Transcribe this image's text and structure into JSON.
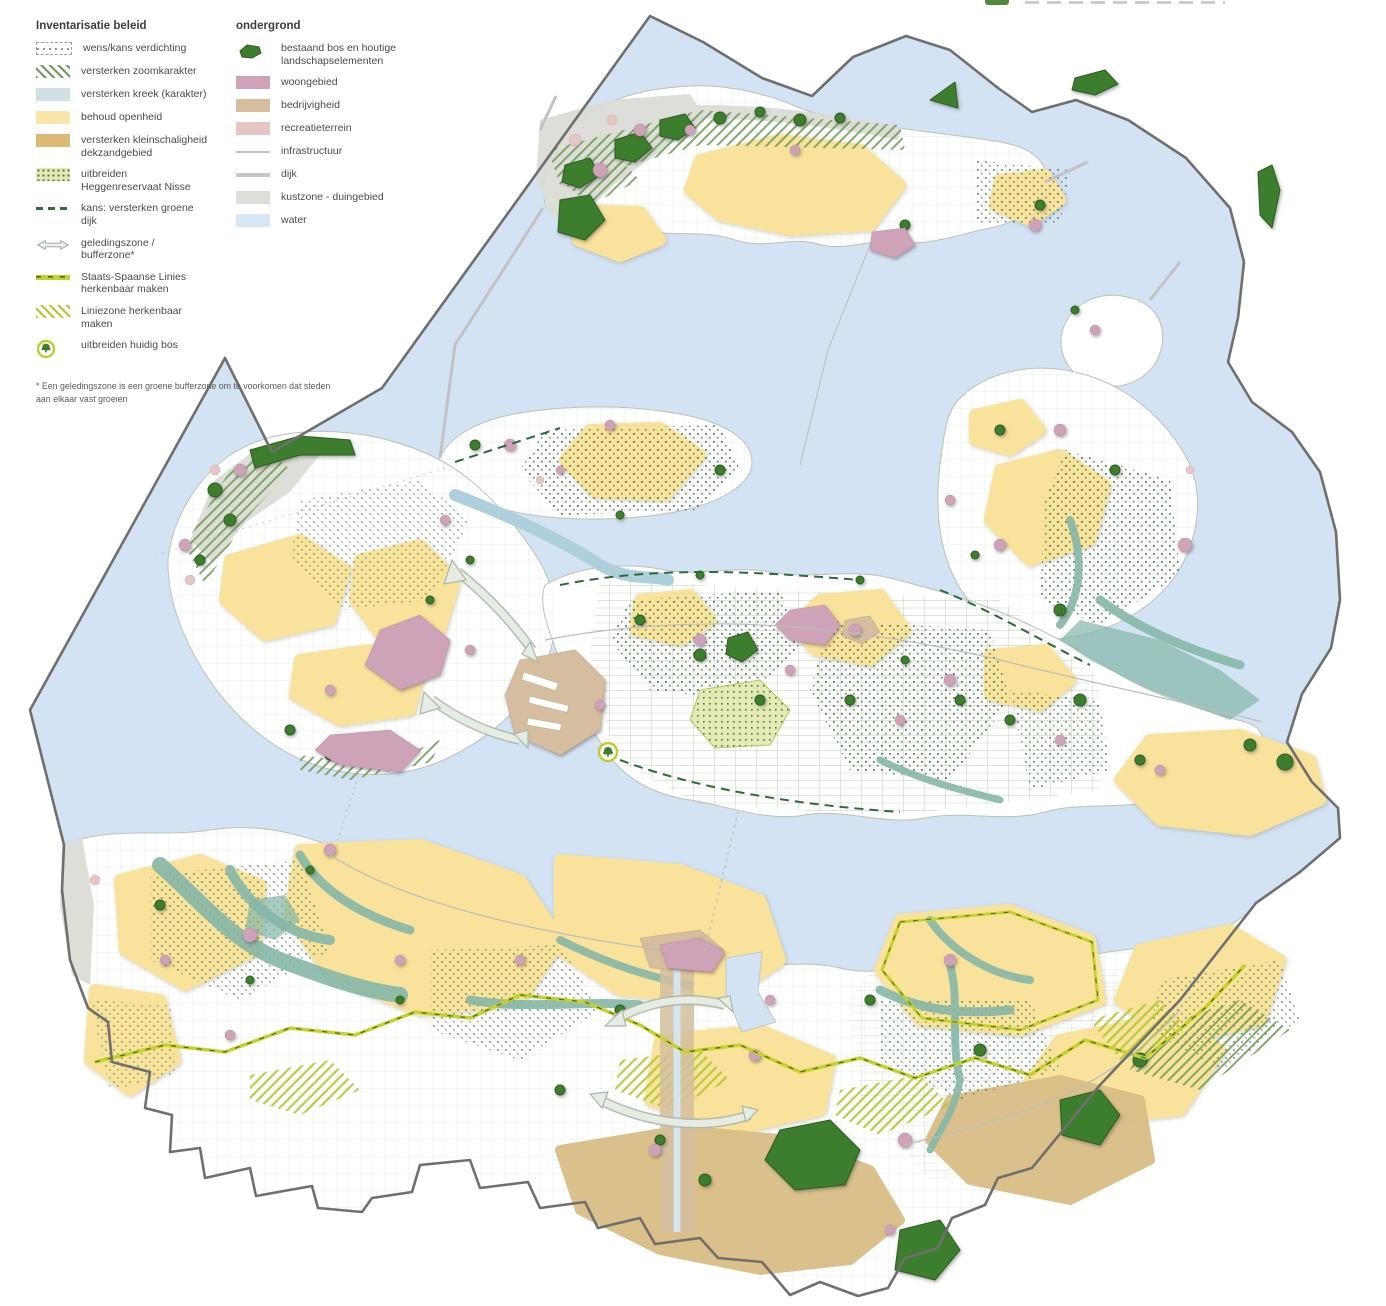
{
  "legend": {
    "inventarisatie": {
      "title": "Inventarisatie beleid",
      "items": [
        {
          "label": "wens/kans verdichting",
          "swatch": "dotted-dashed-outline"
        },
        {
          "label": "versterken zoomkarakter",
          "swatch": "green-diagonal-hatch"
        },
        {
          "label": "versterken kreek (karakter)",
          "swatch": "pale-blue-fill"
        },
        {
          "label": "behoud openheid",
          "swatch": "pale-yellow-fill"
        },
        {
          "label": "versterken kleinschaligheid dekzandgebied",
          "swatch": "ochre-fill"
        },
        {
          "label": "uitbreiden Heggenreservaat Nisse",
          "swatch": "lime-speckle-fill"
        },
        {
          "label": "kans: versterken groene dijk",
          "swatch": "dark-green-dashed-line"
        },
        {
          "label": "geledingszone / bufferzone*",
          "swatch": "double-arrow-outline"
        },
        {
          "label": "Staats-Spaanse Linies herkenbaar maken",
          "swatch": "lime-line-dark-dashes"
        },
        {
          "label": "Liniezone herkenbaar maken",
          "swatch": "lime-diagonal-hatch"
        },
        {
          "label": "uitbreiden huidig bos",
          "swatch": "tree-in-lime-circle"
        }
      ]
    },
    "ondergrond": {
      "title": "ondergrond",
      "items": [
        {
          "label": "bestaand bos en houtige landschapselementen",
          "swatch": "dark-green-blob"
        },
        {
          "label": "woongebied",
          "swatch": "pink-fill"
        },
        {
          "label": "bedrijvigheid",
          "swatch": "tan-fill"
        },
        {
          "label": "recreatieterrein",
          "swatch": "rose-fill"
        },
        {
          "label": "infrastructuur",
          "swatch": "thin-gray-line"
        },
        {
          "label": "dijk",
          "swatch": "thick-gray-line"
        },
        {
          "label": "kustzone - duingebied",
          "swatch": "light-gray-fill"
        },
        {
          "label": "water",
          "swatch": "light-blue-fill"
        }
      ]
    },
    "footnote": "* Een geledingszone is een groene bufferzone om te voorkomen dat steden aan elkaar vast groeien"
  },
  "colors": {
    "water": "#d3e3f3",
    "land": "#ffffff",
    "behoud_openheid_geel": "#f9e29b",
    "woongebied_roze": "#cfa3b7",
    "bedrijvigheid_tan": "#d4be9f",
    "recreatieterrein_rose": "#e6c5c5",
    "bos_donkergroen": "#3e7d2e",
    "kreek_teal": "#85b7a8",
    "dekzand_oker": "#d9be85",
    "linies_limegroen": "#c3d22f",
    "zoomkarakter_hatch_groen": "#6f9c55",
    "kustzone_grijs": "#dcdcd7",
    "infrastructuur_grijs": "#bcbcbc",
    "provinciegrens_grijs": "#6f6f6f",
    "verdichting_dots_groen": "#2e5f33"
  }
}
